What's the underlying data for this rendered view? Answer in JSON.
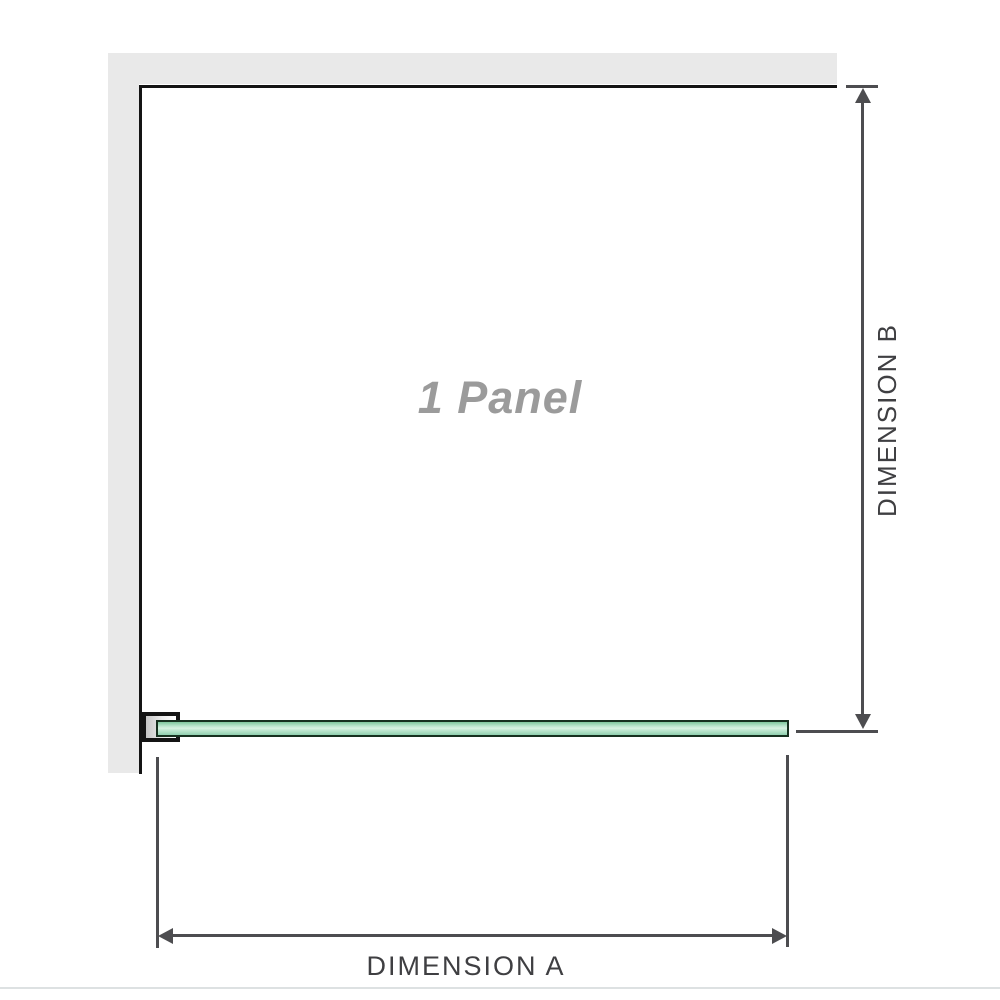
{
  "diagram": {
    "panel": {
      "label": "1 Panel"
    },
    "dimensions": {
      "horizontal": {
        "label": "DIMENSION A"
      },
      "vertical": {
        "label": "DIMENSION B"
      }
    },
    "colors": {
      "wall_gray": "#e9e9e9",
      "outline_black": "#141414",
      "dimension_gray": "#4d4d50",
      "text_dark": "#3f3f42",
      "panel_label_gray": "#9b9b9b",
      "glass_green": "#a8dcc0",
      "glass_green_light": "#d8f2e2",
      "glass_border": "#16301f",
      "divider": "#dde1e2"
    }
  }
}
